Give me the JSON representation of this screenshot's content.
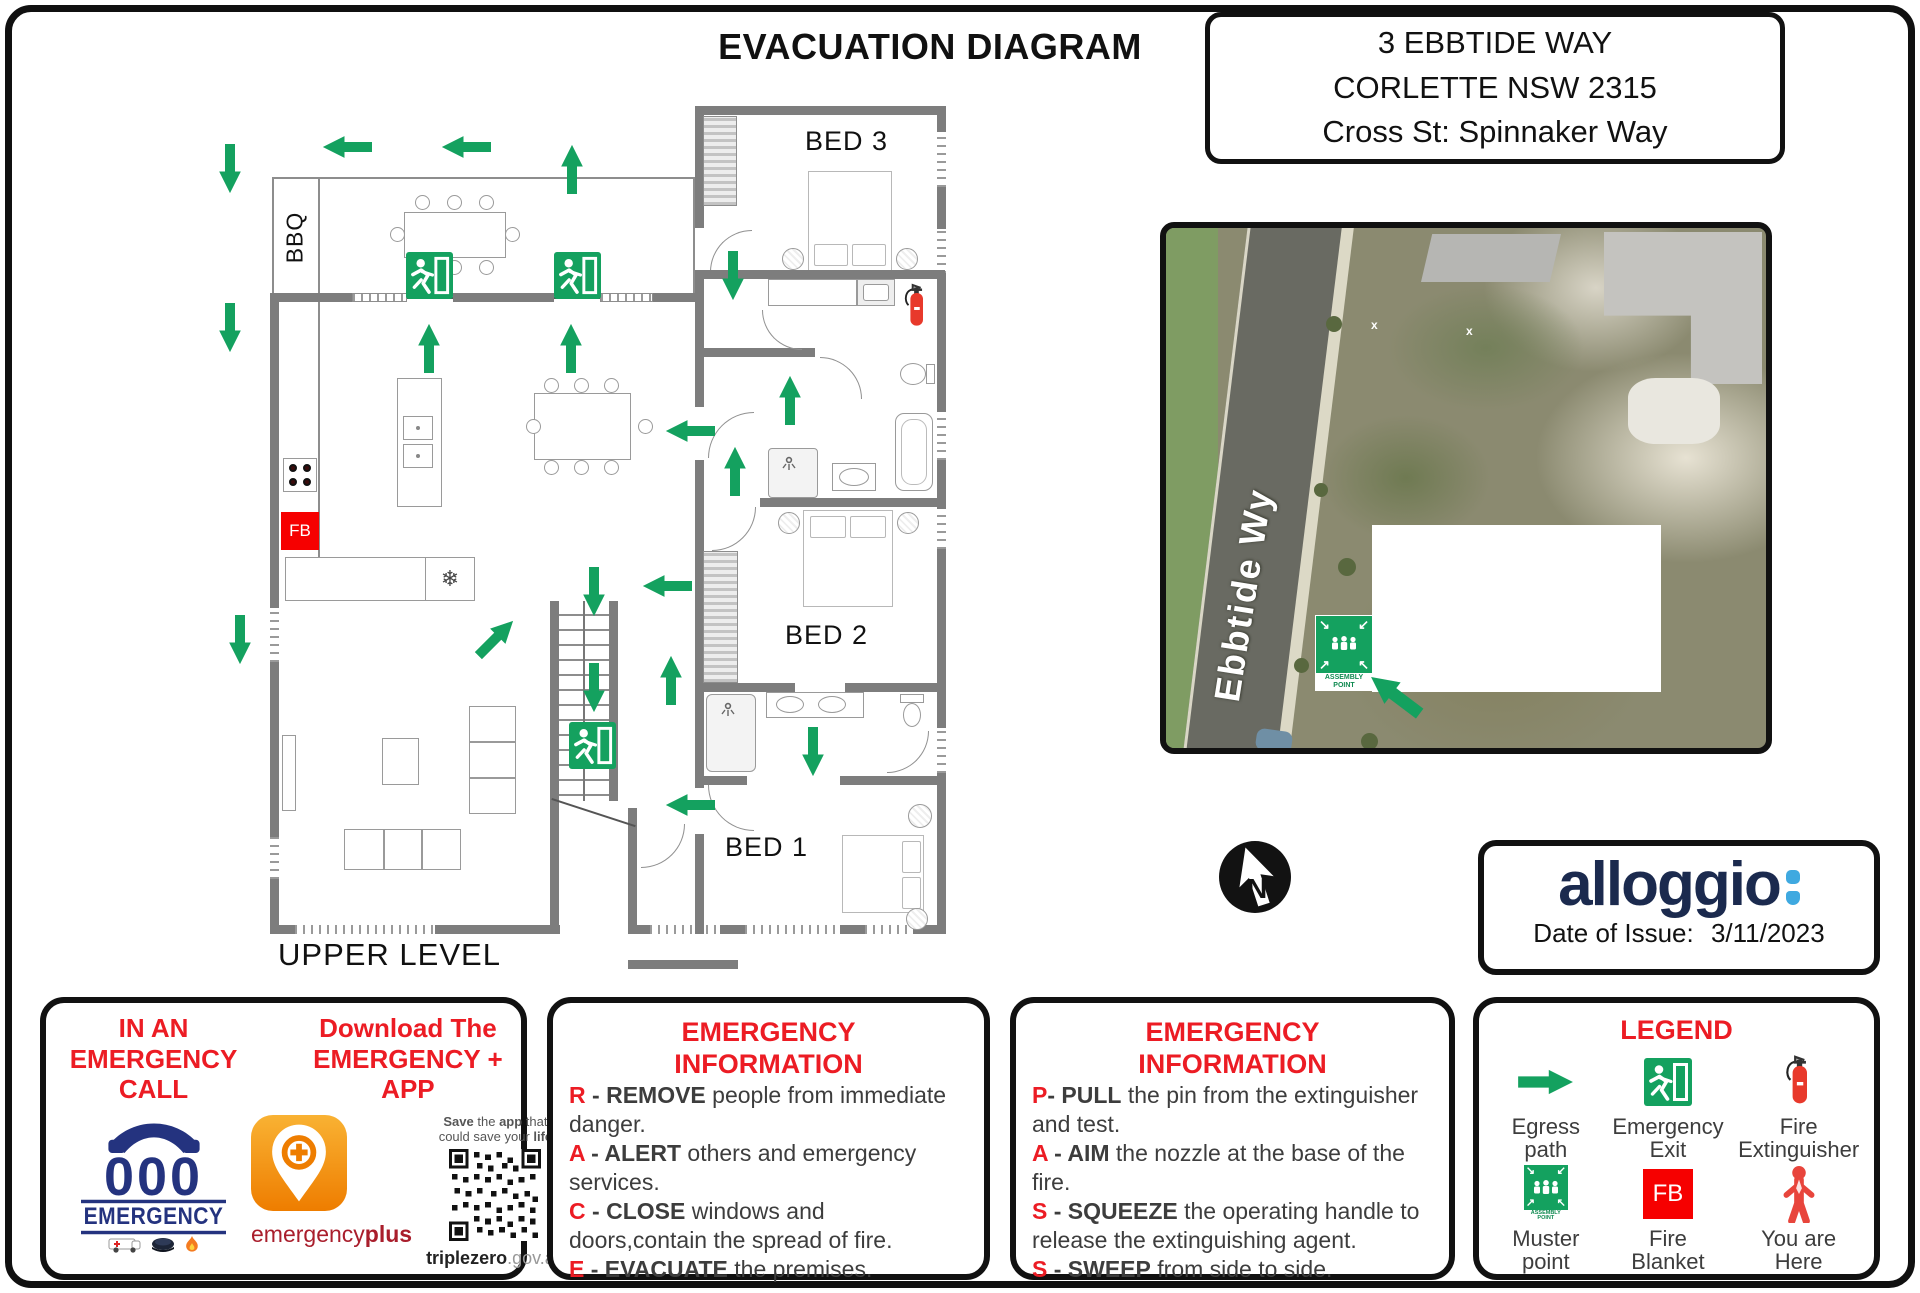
{
  "header": {
    "title": "EVACUATION DIAGRAM",
    "address": {
      "line1": "3 EBBTIDE WAY",
      "line2": "CORLETTE NSW 2315",
      "line3": "Cross St: Spinnaker Way"
    }
  },
  "floor_plan": {
    "level_label": "UPPER LEVEL",
    "bbq_label": "BBQ",
    "bed1_label": "BED 1",
    "bed2_label": "BED 2",
    "bed3_label": "BED 3",
    "fire_blanket_label": "FB"
  },
  "site_map": {
    "street_label": "Ebbtide Wy",
    "assembly_sign_text": "ASSEMBLY POINT"
  },
  "compass": {
    "north_label": "N"
  },
  "issuer": {
    "brand": "alloggio",
    "date_label": "Date of Issue:",
    "date_value": "3/11/2023"
  },
  "emergency_call_box": {
    "heading_call": "IN AN EMERGENCY CALL",
    "heading_app": "Download The EMERGENCY + APP",
    "phone_number": "000",
    "phone_caption": "EMERGENCY",
    "app_wordmark_regular": "emergency",
    "app_wordmark_bold": "plus",
    "qr_caption": {
      "w1": "Save",
      "w2": " the ",
      "w3": "app",
      "w4": " that",
      "w5": "could save your ",
      "w6": "life"
    },
    "qr_domain_bold": "triplezero",
    "qr_domain_rest": ".gov.au"
  },
  "race_box": {
    "heading_line1": "EMERGENCY",
    "heading_line2": "INFORMATION",
    "items": [
      {
        "letter": "R",
        "sep": " - ",
        "keyword": "REMOVE",
        "text": " people from immediate danger."
      },
      {
        "letter": "A",
        "sep": " - ",
        "keyword": "ALERT",
        "text": " others and emergency services."
      },
      {
        "letter": "C",
        "sep": " - ",
        "keyword": "CLOSE",
        "text": " windows and doors,contain the spread of fire."
      },
      {
        "letter": "E",
        "sep": " - ",
        "keyword": "EVACUATE",
        "text": " the premises."
      }
    ]
  },
  "pass_box": {
    "heading_line1": "EMERGENCY",
    "heading_line2": "INFORMATION",
    "items": [
      {
        "letter": "P",
        "sep": "- ",
        "keyword": "PULL",
        "text": " the pin from the extinguisher and test."
      },
      {
        "letter": "A",
        "sep": " - ",
        "keyword": "AIM",
        "text": " the nozzle at the base of the fire."
      },
      {
        "letter": "S",
        "sep": " - ",
        "keyword": "SQUEEZE",
        "text": " the operating handle to release the extinguishing agent."
      },
      {
        "letter": "S",
        "sep": " - ",
        "keyword": "SWEEP",
        "text": " from side to side."
      }
    ]
  },
  "legend_box": {
    "heading": "LEGEND",
    "items": [
      "Egress path",
      "Emergency Exit",
      "Fire Extinguisher",
      "Muster point",
      "Fire Blanket",
      "You are Here"
    ],
    "muster_sign_text": "ASSEMBLY POINT",
    "fire_blanket_abbr": "FB"
  },
  "colors": {
    "egress_green": "#14A15F",
    "heading_red": "#EC1C24",
    "fire_blanket_red": "#F60000",
    "extinguisher_red": "#E8392B",
    "wall_gray": "#7D7D7D",
    "brand_navy": "#1B2A4E",
    "brand_light_blue": "#3FA9E0"
  }
}
